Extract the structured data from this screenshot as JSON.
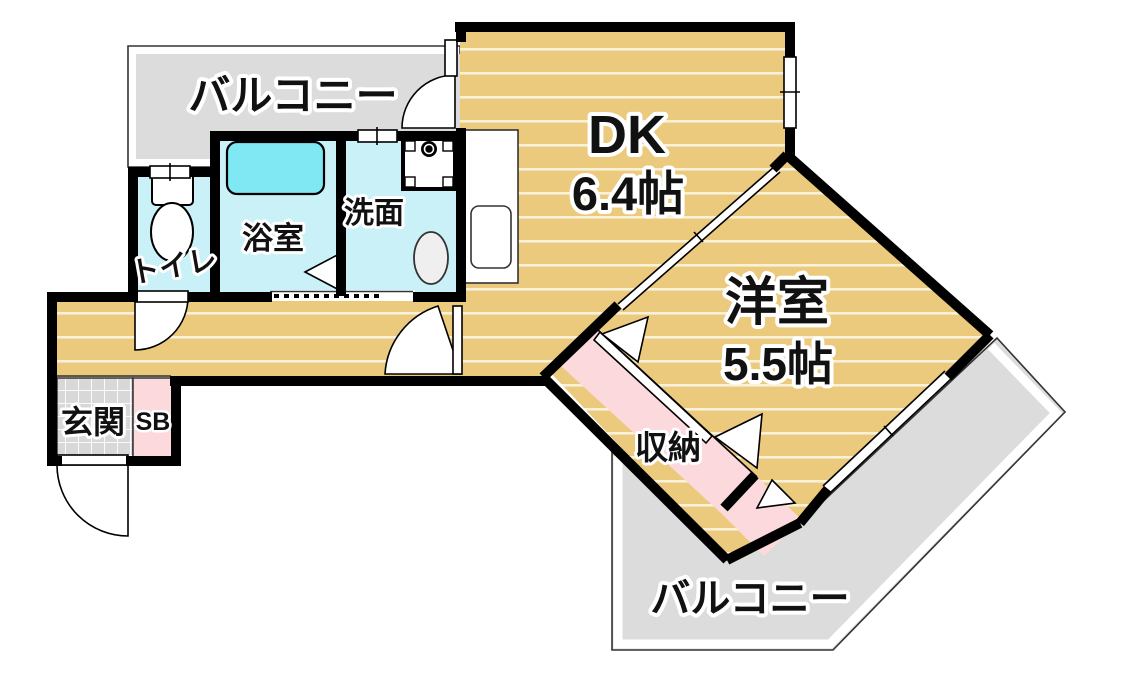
{
  "floorplan": {
    "type": "japanese-apartment-madori",
    "labels": {
      "balcony_top": "バルコニー",
      "balcony_bottom": "バルコニー",
      "dk": "DK",
      "dk_size": "6.4帖",
      "western": "洋室",
      "western_size": "5.5帖",
      "storage": "収納",
      "bath": "浴室",
      "washroom": "洗面",
      "toilet": "トイレ",
      "entrance": "玄関",
      "shoebox": "SB"
    },
    "rooms": [
      {
        "name": "バルコニー",
        "size": "",
        "position": "top-left"
      },
      {
        "name": "DK",
        "size": "6.4帖",
        "position": "center-top"
      },
      {
        "name": "洋室",
        "size": "5.5帖",
        "position": "right-rotated-45deg"
      },
      {
        "name": "収納",
        "size": "",
        "position": "below-western-room"
      },
      {
        "name": "浴室",
        "size": "",
        "position": "left-center"
      },
      {
        "name": "洗面",
        "size": "",
        "position": "center-left"
      },
      {
        "name": "トイレ",
        "size": "",
        "position": "far-left"
      },
      {
        "name": "玄関",
        "size": "",
        "position": "bottom-left"
      },
      {
        "name": "SB",
        "size": "",
        "position": "bottom-left"
      },
      {
        "name": "バルコニー",
        "size": "",
        "position": "bottom-right"
      }
    ],
    "colors": {
      "floor_tan": "#ebc97d",
      "floor_stripe": "#f9f1d8",
      "wet_room_cyan": "#c9f1f7",
      "bathtub_cyan": "#7fe8f2",
      "closet_pink": "#fcd9dc",
      "balcony_gray": "#dcdcdc",
      "entrance_tile_gray": "#d8d8d8",
      "wall_black": "#000000"
    }
  }
}
